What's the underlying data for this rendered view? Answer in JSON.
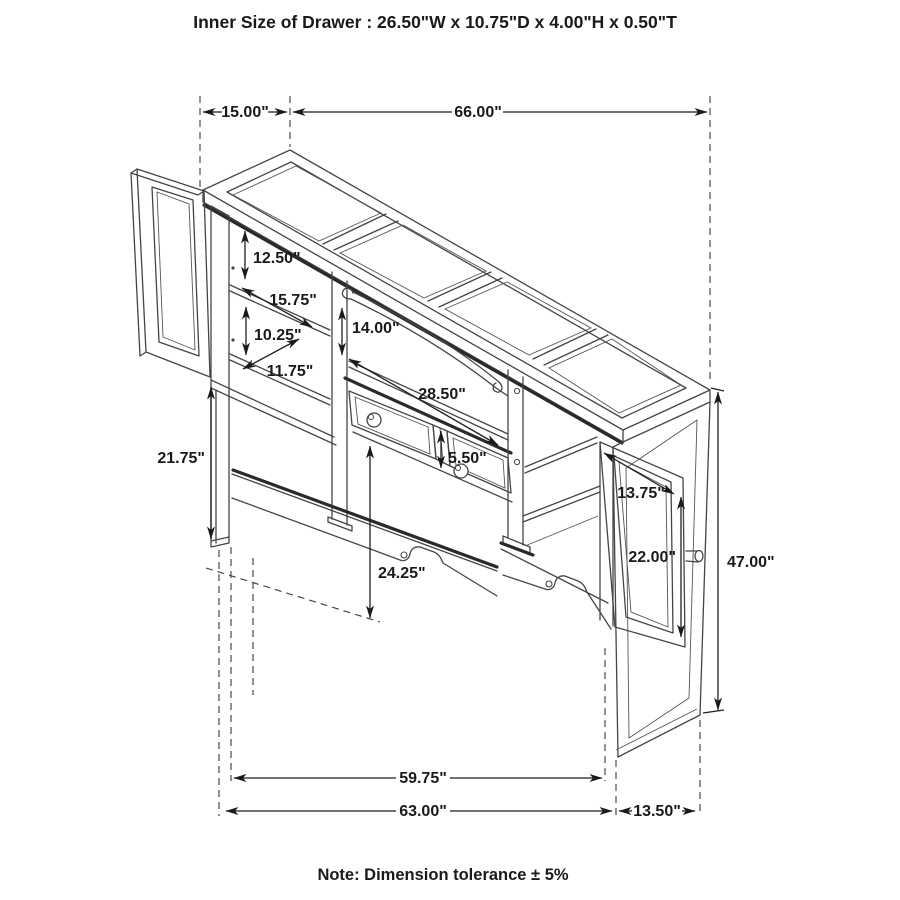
{
  "title": "Inner Size of Drawer : 26.50\"W x 10.75\"D x 4.00\"H x 0.50\"T",
  "note": "Note: Dimension tolerance ± 5%",
  "colors": {
    "line": "#454545",
    "heavy": "#2a2a2a",
    "dimension": "#1f1f1f",
    "text": "#1a1a1a",
    "background": "#ffffff"
  },
  "dims": {
    "top_depth": "15.00\"",
    "top_width": "66.00\"",
    "upper_left_opening_height": "12.50\"",
    "upper_shelf_width": "15.75\"",
    "lower_left_opening_height": "10.25\"",
    "lower_shelf_depth": "11.75\"",
    "center_opening_height": "14.00\"",
    "drawer_span_width": "28.50\"",
    "drawer_height": "5.50\"",
    "left_leg_height": "21.75\"",
    "right_door_width": "13.75\"",
    "right_door_height": "22.00\"",
    "overall_height": "47.00\"",
    "center_clearance_height": "24.25\"",
    "bottom_inner_width": "59.75\"",
    "bottom_outer_width": "63.00\"",
    "side_depth_bottom": "13.50\""
  }
}
